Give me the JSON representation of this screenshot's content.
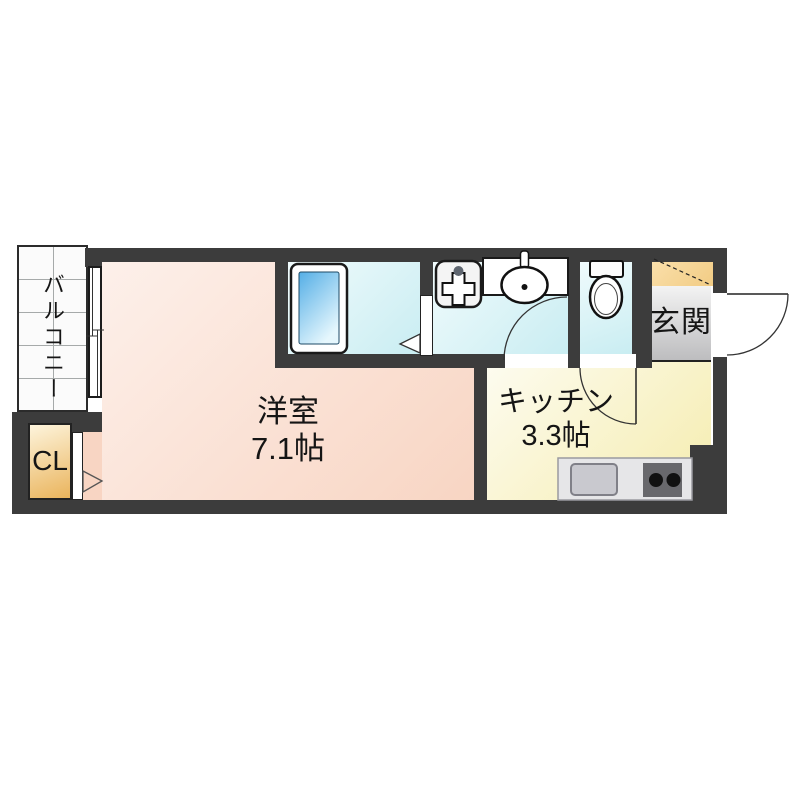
{
  "colors": {
    "wall": "#3c3c3c",
    "western1": "#fdf0ea",
    "western2": "#f8d5c3",
    "water1": "#f0fbfc",
    "water2": "#c9edf2",
    "kitchen1": "#fdfcf0",
    "kitchen2": "#f5ecae",
    "genkan1": "#f3f3f3",
    "genkan2": "#bdbdbf",
    "shoe1": "#fae0ac",
    "shoe2": "#f2cc84",
    "closet1": "#fdf4dc",
    "closet2": "#eab45c",
    "tub1": "#54aee6",
    "tub2": "#e6f7fd"
  },
  "rooms": {
    "balcony": {
      "label": "バルコニー"
    },
    "western": {
      "label": "洋室",
      "size": "7.1帖"
    },
    "kitchen": {
      "label": "キッチン",
      "size": "3.3帖"
    },
    "entrance": {
      "label": "玄関"
    },
    "closet": {
      "label": "CL"
    }
  },
  "fixtures": {
    "bathtub": "bathtub-icon",
    "washing_machine_pan": "washing-machine-pan-icon",
    "vanity_sink": "washbasin-icon",
    "toilet": "toilet-icon",
    "kitchen_sink": "kitchen-sink-icon",
    "stove": "two-burner-stove-icon",
    "entrance_door": "door-swing-icon",
    "shoe_cabinet": "shoe-cabinet-diagonal-icon",
    "sliding_window": "sliding-window-icon"
  }
}
